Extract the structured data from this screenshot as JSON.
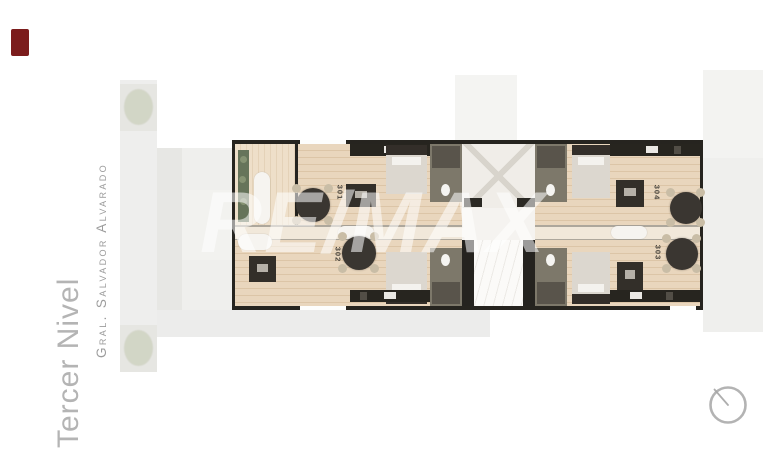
{
  "title": {
    "text": "Tercer Nivel"
  },
  "street": {
    "name": "Gral. Salvador Alvarado"
  },
  "watermark": {
    "text": "RE/MAX"
  },
  "units": [
    {
      "number": "301"
    },
    {
      "number": "302"
    },
    {
      "number": "303"
    },
    {
      "number": "304"
    }
  ],
  "colors": {
    "badge": "#7b1c1c",
    "title_text": "#b4b4b4",
    "street_text": "#9c9c9c",
    "wall": "#26241f",
    "wood": "#e9d6bd",
    "wood_seam": "#dcc5a7",
    "balcony_wood": "#eedfc9",
    "mid_strip": "#f1e8da",
    "planter": "#66745a",
    "tree": "#c6cab6",
    "street_strip": "#ebebe9",
    "faded_block": "#efefed",
    "dark_furniture": "#3a3631",
    "bed": "#dcd7cf",
    "bath": "#7d786a",
    "core": "#f0ede8",
    "elevator": "#fbfaf8",
    "sofa": "#f6f4f0",
    "watermark": "rgba(255,255,255,0.55)",
    "compass": "#a6a6a6"
  }
}
